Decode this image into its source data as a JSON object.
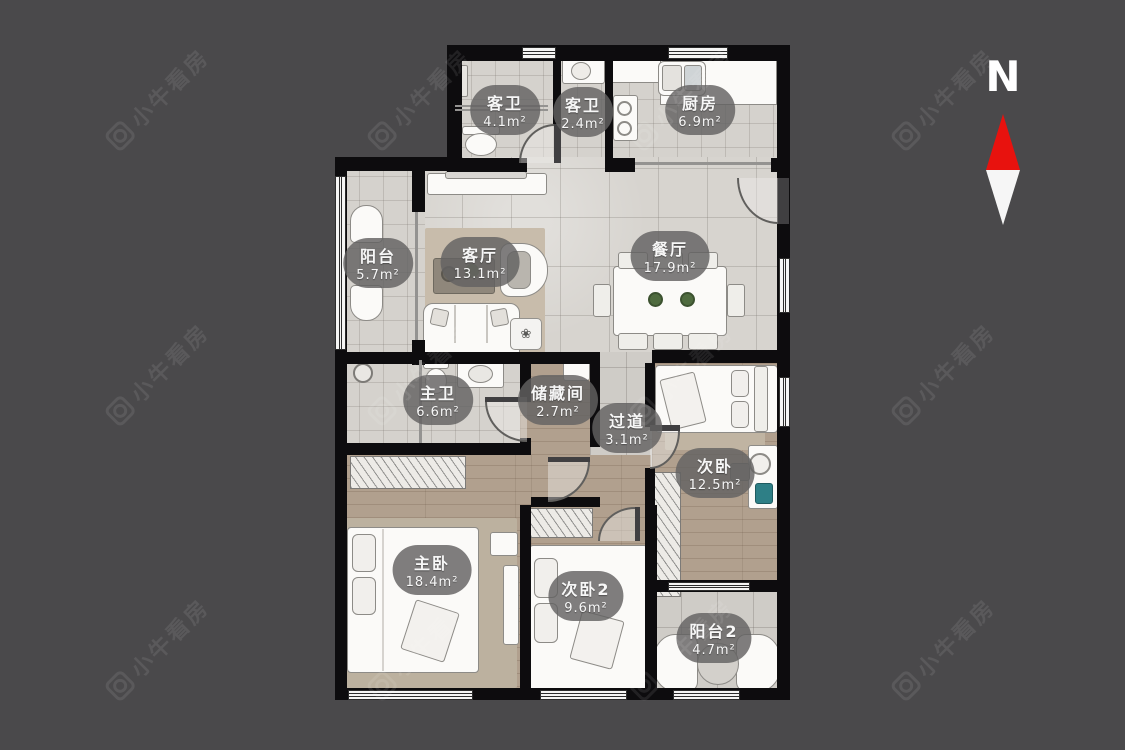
{
  "watermark": {
    "text": "小牛看房"
  },
  "compass": {
    "label": "N"
  },
  "rooms": [
    {
      "id": "guest-bath-1",
      "name": "客卫",
      "area": "4.1m²"
    },
    {
      "id": "guest-bath-2",
      "name": "客卫",
      "area": "2.4m²"
    },
    {
      "id": "kitchen",
      "name": "厨房",
      "area": "6.9m²"
    },
    {
      "id": "balcony",
      "name": "阳台",
      "area": "5.7m²"
    },
    {
      "id": "living-room",
      "name": "客厅",
      "area": "13.1m²"
    },
    {
      "id": "dining-room",
      "name": "餐厅",
      "area": "17.9m²"
    },
    {
      "id": "master-bath",
      "name": "主卫",
      "area": "6.6m²"
    },
    {
      "id": "storage-room",
      "name": "储藏间",
      "area": "2.7m²"
    },
    {
      "id": "corridor",
      "name": "过道",
      "area": "3.1m²"
    },
    {
      "id": "bedroom-2",
      "name": "次卧",
      "area": "12.5m²"
    },
    {
      "id": "master-bedroom",
      "name": "主卧",
      "area": "18.4m²"
    },
    {
      "id": "bedroom-3",
      "name": "次卧2",
      "area": "9.6m²"
    },
    {
      "id": "balcony-2",
      "name": "阳台2",
      "area": "4.7m²"
    }
  ],
  "colors": {
    "background": "#4a494b",
    "wall": "#0d0c0e",
    "tile_floor": "#d5d2cd",
    "wood_floor": "#b1a08e",
    "label_bg": "rgba(99,98,98,0.82)",
    "label_text": "#f7f7f7",
    "compass_red": "#e8120e",
    "compass_white": "#f6f6f6"
  }
}
